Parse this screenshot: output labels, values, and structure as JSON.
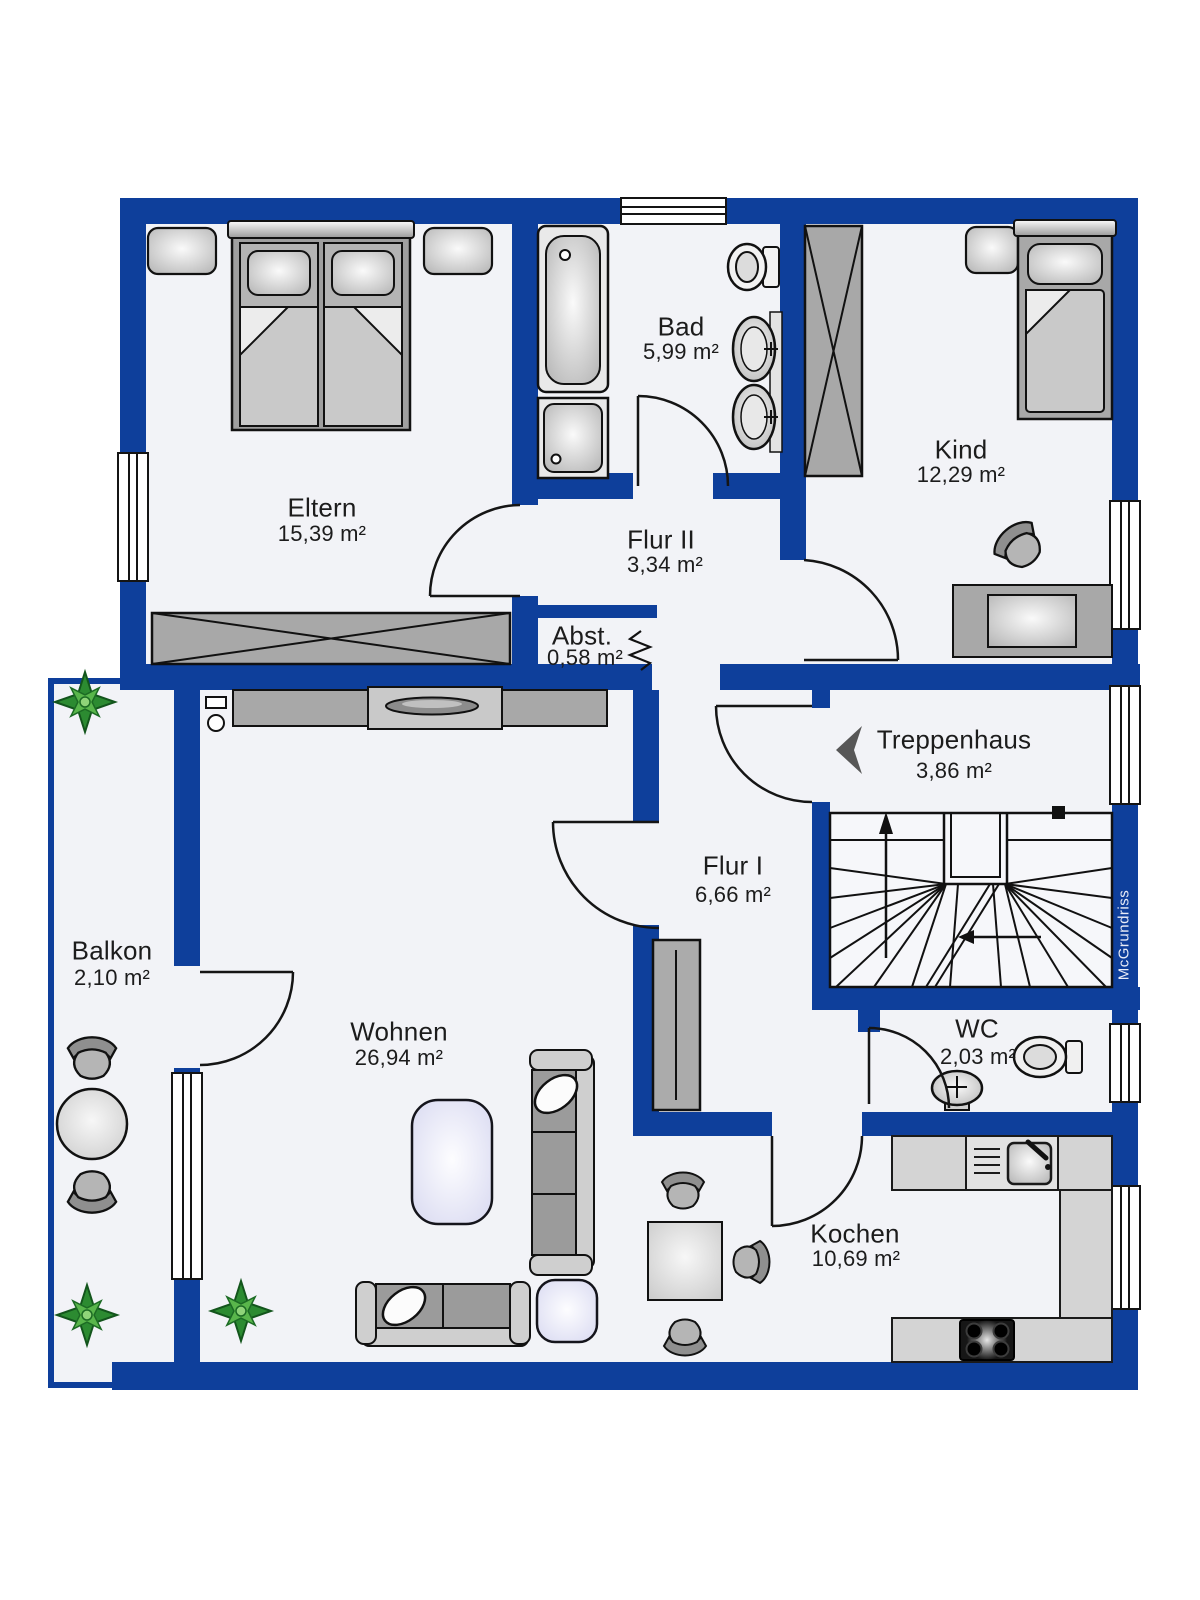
{
  "watermark": "McGrundriss",
  "rooms": {
    "eltern": {
      "name": "Eltern",
      "area": "15,39 m²"
    },
    "bad": {
      "name": "Bad",
      "area": "5,99 m²"
    },
    "flur2": {
      "name": "Flur II",
      "area": "3,34 m²"
    },
    "kind": {
      "name": "Kind",
      "area": "12,29 m²"
    },
    "abst": {
      "name": "Abst.",
      "area": "0,58 m²"
    },
    "treppenhaus": {
      "name": "Treppenhaus",
      "area": "3,86 m²"
    },
    "flur1": {
      "name": "Flur I",
      "area": "6,66 m²"
    },
    "balkon": {
      "name": "Balkon",
      "area": "2,10 m²"
    },
    "wohnen": {
      "name": "Wohnen",
      "area": "26,94 m²"
    },
    "wc": {
      "name": "WC",
      "area": "2,03 m²"
    },
    "kochen": {
      "name": "Kochen",
      "area": "10,69 m²"
    }
  },
  "colors": {
    "wall": "#0e3f9b",
    "floor": "#f2f3f7",
    "accent_furniture": "#a8a8a8"
  }
}
